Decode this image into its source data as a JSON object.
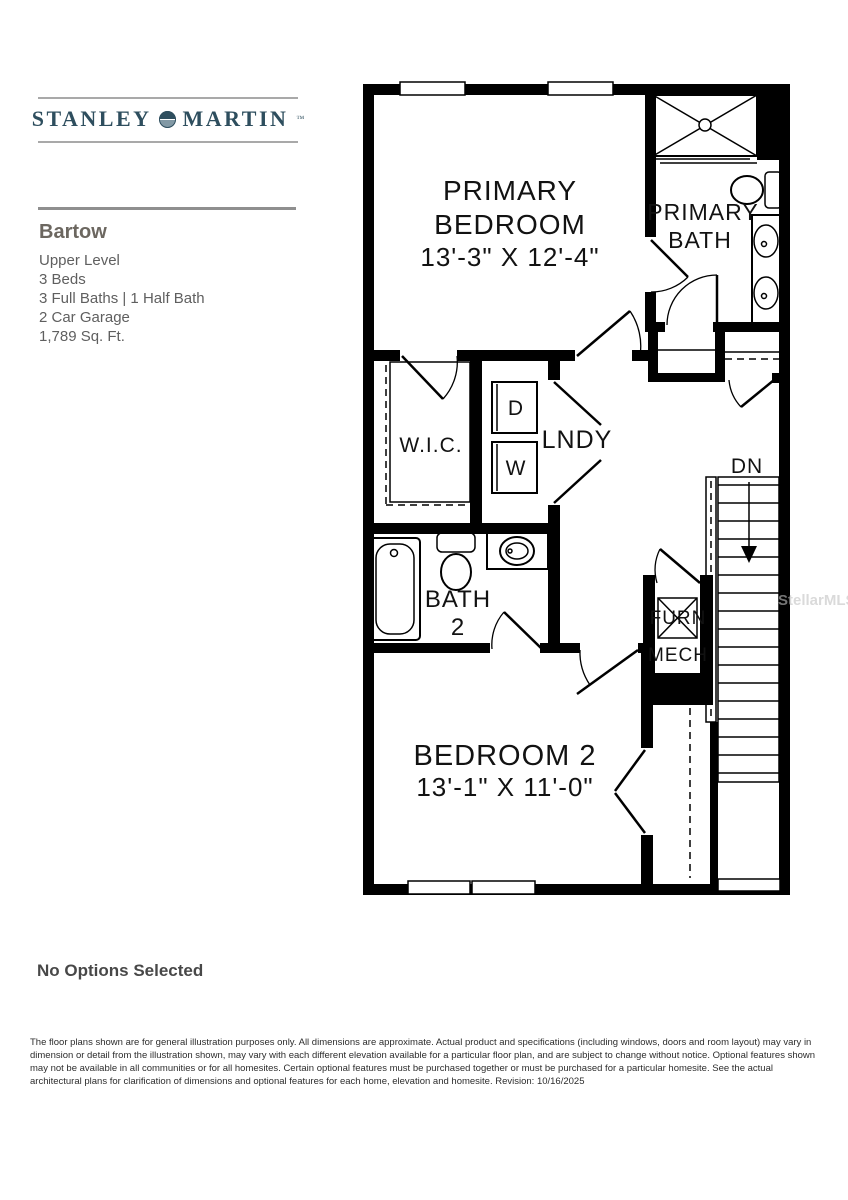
{
  "colors": {
    "brand_navy": "#2e4e5e",
    "wall_black": "#000000",
    "rule_gray": "#a9a9a9",
    "heading_gray": "#6c6760",
    "text_gray": "#5f5f5f",
    "watermark_gray": "#c2c2c2"
  },
  "icons": {
    "logo_mark": "shield-globe-icon"
  },
  "brand": {
    "name_left": "STANLEY",
    "name_right": "MARTIN",
    "tm": "™"
  },
  "plan": {
    "name": "Bartow",
    "level": "Upper Level",
    "beds": "3 Beds",
    "baths": "3 Full Baths | 1 Half Bath",
    "garage": "2 Car Garage",
    "sqft": "1,789 Sq. Ft."
  },
  "options": {
    "text": "No Options Selected"
  },
  "disclaimer": "The floor plans shown are for general illustration purposes only. All dimensions are approximate. Actual product and specifications (including windows, doors and room layout) may vary in dimension or detail from the illustration shown, may vary with each different elevation available for a particular floor plan, and are subject to change without notice. Optional features shown may not be available in all communities or for all homesites. Certain optional features must be purchased together or must be purchased for a particular homesite. See the actual architectural plans for clarification of dimensions and optional features for each home, elevation and homesite. Revision: 10/16/2025",
  "floorplan": {
    "watermark": "StellarMLS",
    "rooms": {
      "primary_bedroom": {
        "line1": "PRIMARY",
        "line2": "BEDROOM",
        "dims": "13'-3\" X 12'-4\""
      },
      "primary_bath": {
        "line1": "PRIMARY",
        "line2": "BATH"
      },
      "wic": {
        "label": "W.I.C."
      },
      "laundry": {
        "label": "LNDY",
        "dryer": "D",
        "washer": "W"
      },
      "stairs": {
        "label": "DN"
      },
      "bath2": {
        "line1": "BATH",
        "line2": "2"
      },
      "mech": {
        "line1": "FURN",
        "line2": "MECH"
      },
      "bedroom2": {
        "line1": "BEDROOM 2",
        "dims": "13'-1\" X 11'-0\""
      }
    }
  }
}
